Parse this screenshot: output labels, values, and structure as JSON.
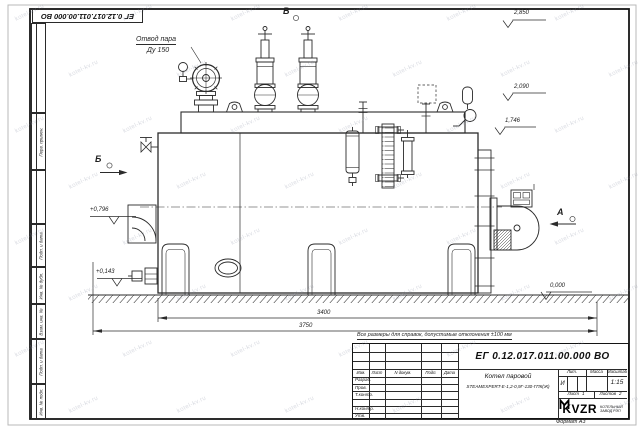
{
  "watermark": {
    "text": "kotel-kv.ru"
  },
  "sheet": {
    "top_designation": "ЕГ 0.12.017.011.00.000  ВО",
    "format_note": "Формат А3",
    "margin_fields": [
      "Перв. примен.",
      "Подп. и дата",
      "Инв. № дубл.",
      "Взам. инв. №",
      "Подп. и дата",
      "Инв. № подл."
    ]
  },
  "drawing": {
    "steam_outlet_label_line1": "Отвод пара",
    "steam_outlet_label_line2": "Ду 150",
    "view_labels": {
      "a": "А",
      "b": "Б",
      "v": "В"
    },
    "levels": {
      "top": "2,850",
      "platform": "2,090",
      "gauge": "1,746",
      "elbow": "+0,796",
      "low": "+0,143",
      "ground": "0,000"
    },
    "dimensions": {
      "body_length": "3400",
      "overall_length": "3750"
    }
  },
  "note": "Все размеры для справок, допустимые отклонения ±100 мм",
  "title_block": {
    "designation": "ЕГ 0.12.017.011.00.000  ВО",
    "product_line1": "Котел паровой",
    "product_line2": "STEAMEXPERT-Е-1,2-0,9Г-130-ГПК(Ж)",
    "rev_cols": [
      "Изм.",
      "Лист",
      "N докум.",
      "Подп.",
      "Дата"
    ],
    "sig_rows": [
      "Разраб.",
      "Пров.",
      "Т.контр.",
      "",
      "Н.контр.",
      "Утв."
    ],
    "lit_label": "Лит.",
    "lit_value": "И",
    "mass_label": "Масса",
    "scale_label": "Масштаб",
    "scale_value": "1:15",
    "sheet_label": "Лист",
    "sheet_value": "1",
    "sheets_label": "Листов",
    "sheets_value": "2",
    "company": {
      "logo": "KVZR",
      "line1": "КОТЕЛЬНЫЙ",
      "line2": "ЗАВОД РЭП"
    }
  }
}
